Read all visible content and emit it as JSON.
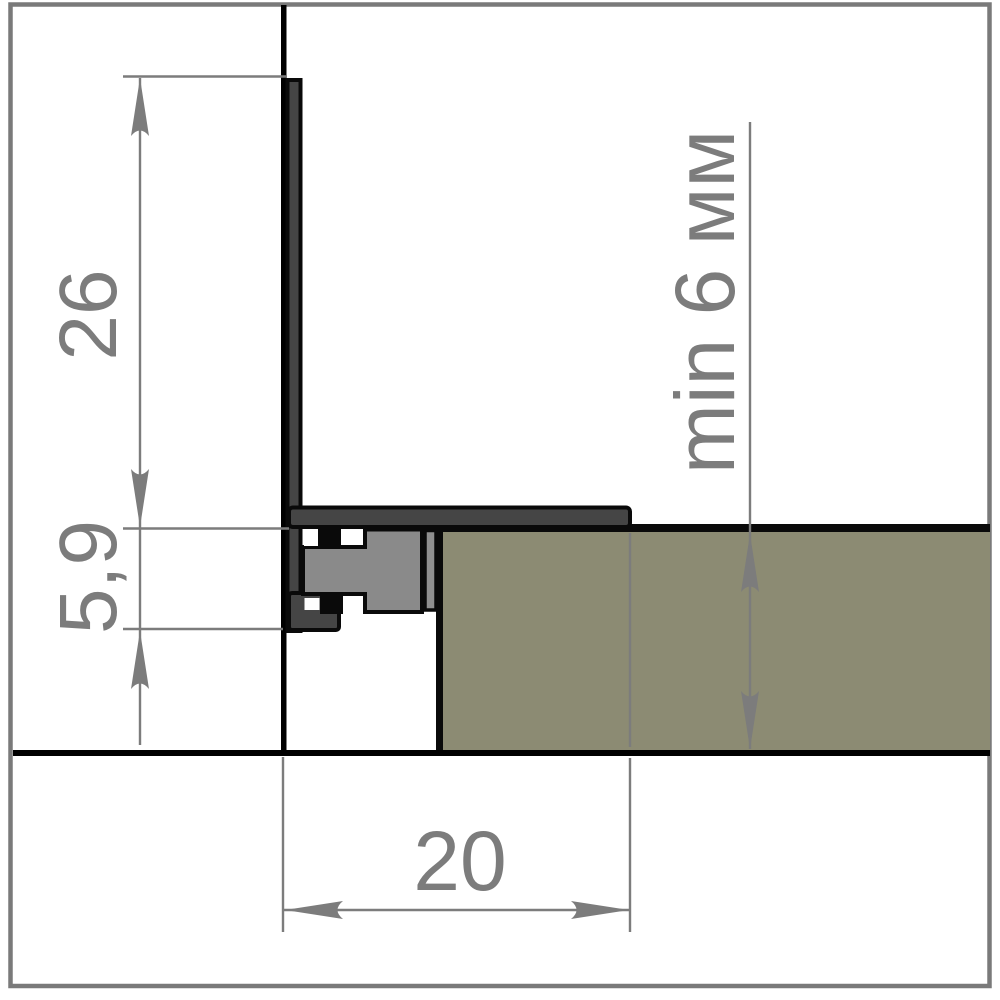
{
  "drawing_type": "profile-cross-section",
  "colors": {
    "background": "#ffffff",
    "frame_border": "#7a7a7a",
    "outline": "#0a0a0a",
    "wall_line": "#000000",
    "floor_line": "#000000",
    "profile_dark": "#454545",
    "profile_body": "#8a8a8a",
    "profile_insert_strip": "#8f8f8f",
    "panel_fill": "#8c8b73",
    "dimension_gray": "#7c7c7c"
  },
  "dimensions": {
    "leg_height": {
      "label": "26"
    },
    "base_height": {
      "label": "5,9"
    },
    "flange_width": {
      "label": "20"
    },
    "panel_thickness": {
      "label": "min 6 мм"
    }
  }
}
